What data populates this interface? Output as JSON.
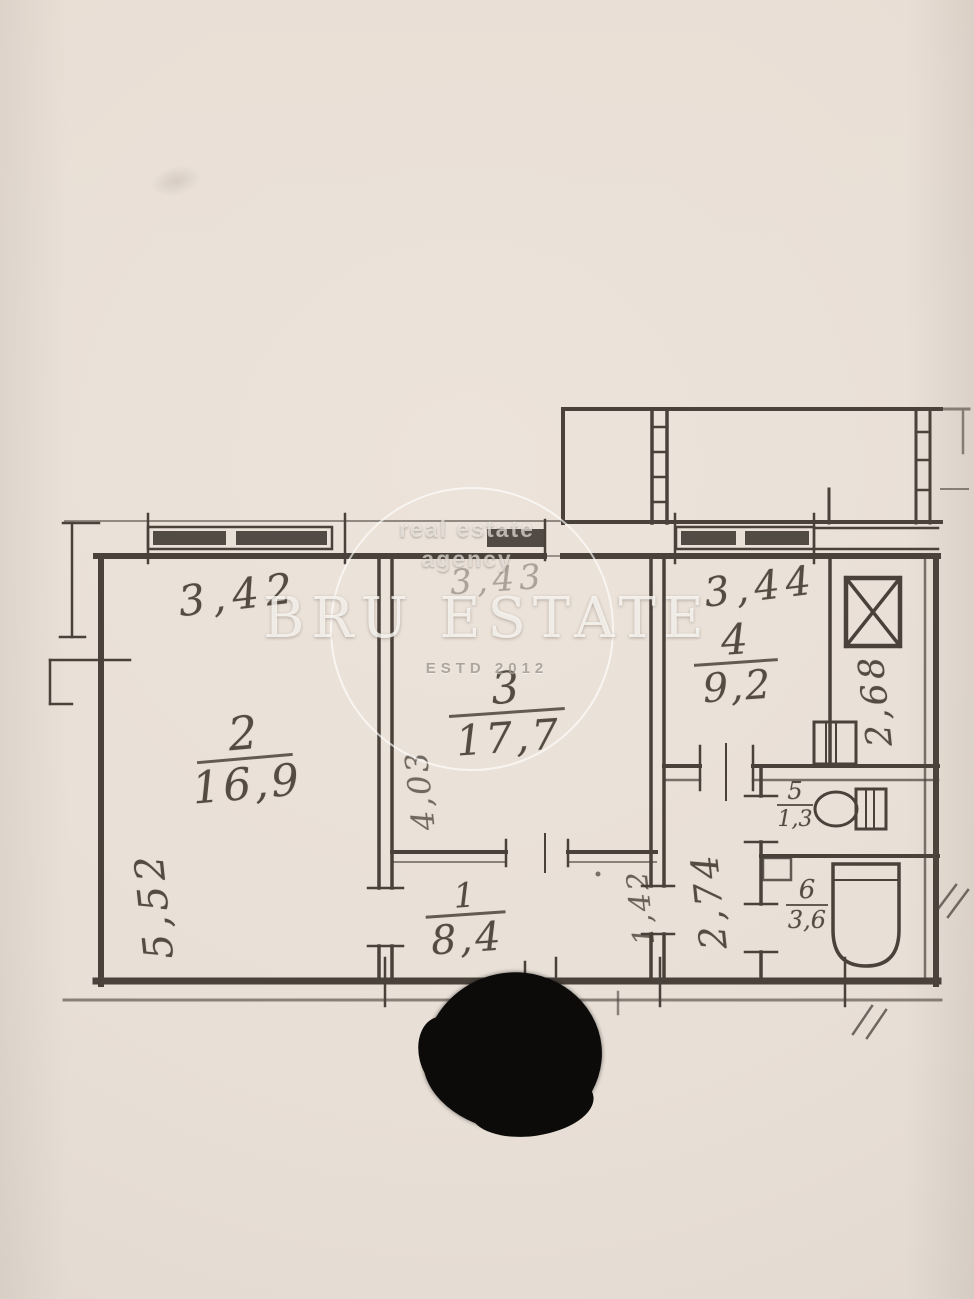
{
  "watermark": {
    "tagline_line1": "real estate",
    "tagline_line2": "agency",
    "brand": "BRU ESTATE",
    "established": "ESTD 2012"
  },
  "plan": {
    "rooms": {
      "r1": {
        "number": "1",
        "area": "8,4"
      },
      "r2": {
        "number": "2",
        "area": "16,9"
      },
      "r3": {
        "number": "3",
        "area": "17,7"
      },
      "r4": {
        "number": "4",
        "area": "9,2"
      },
      "r5": {
        "number": "5",
        "area": "1,3"
      },
      "r6": {
        "number": "6",
        "area": "3,6"
      }
    },
    "dimensions": {
      "room2_width": "3,42",
      "room3_width": "3,43",
      "room4_width": "3,44",
      "room2_depth": "5,52",
      "room3_depth": "4,03",
      "hall_depth": "1,42",
      "corridor_depth": "2,74",
      "kitchen_side": "2,68"
    },
    "fixtures": [
      "vent-shaft",
      "kitchen-sink",
      "toilet",
      "washbasin",
      "bathtub"
    ],
    "colors": {
      "paper": "#e9e0d7",
      "ink": "#49413a",
      "watermark": "#ffffff",
      "marker_blob": "#0c0b0a"
    }
  }
}
